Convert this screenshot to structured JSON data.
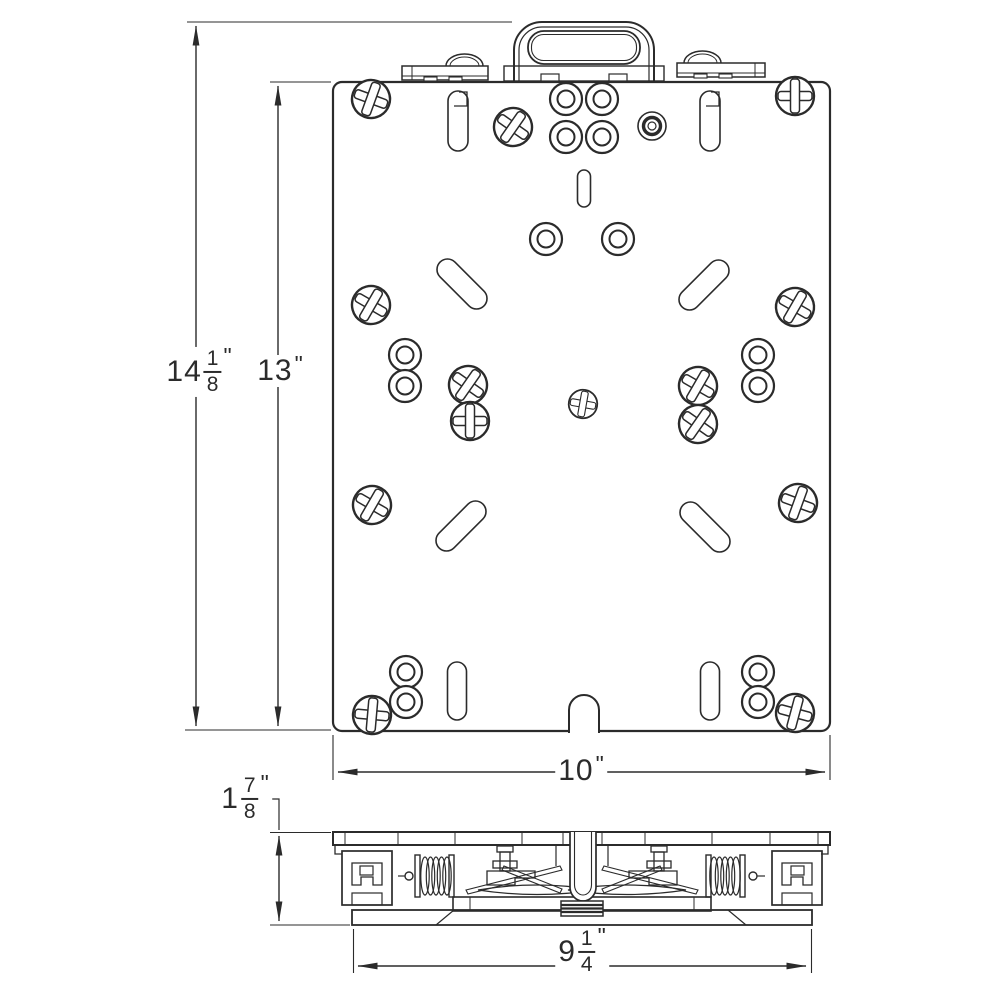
{
  "style": {
    "ink": "#2b2b2b",
    "paper": "#ffffff"
  },
  "dimensions": {
    "overall_height": {
      "whole": "14",
      "numerator": "1",
      "denominator": "8",
      "unit": "\""
    },
    "plate_height": {
      "whole": "13",
      "unit": "\""
    },
    "plate_width": {
      "whole": "10",
      "unit": "\""
    },
    "profile_height": {
      "whole": "1",
      "numerator": "7",
      "denominator": "8",
      "unit": "\""
    },
    "base_width": {
      "whole": "9",
      "numerator": "1",
      "denominator": "4",
      "unit": "\""
    }
  }
}
